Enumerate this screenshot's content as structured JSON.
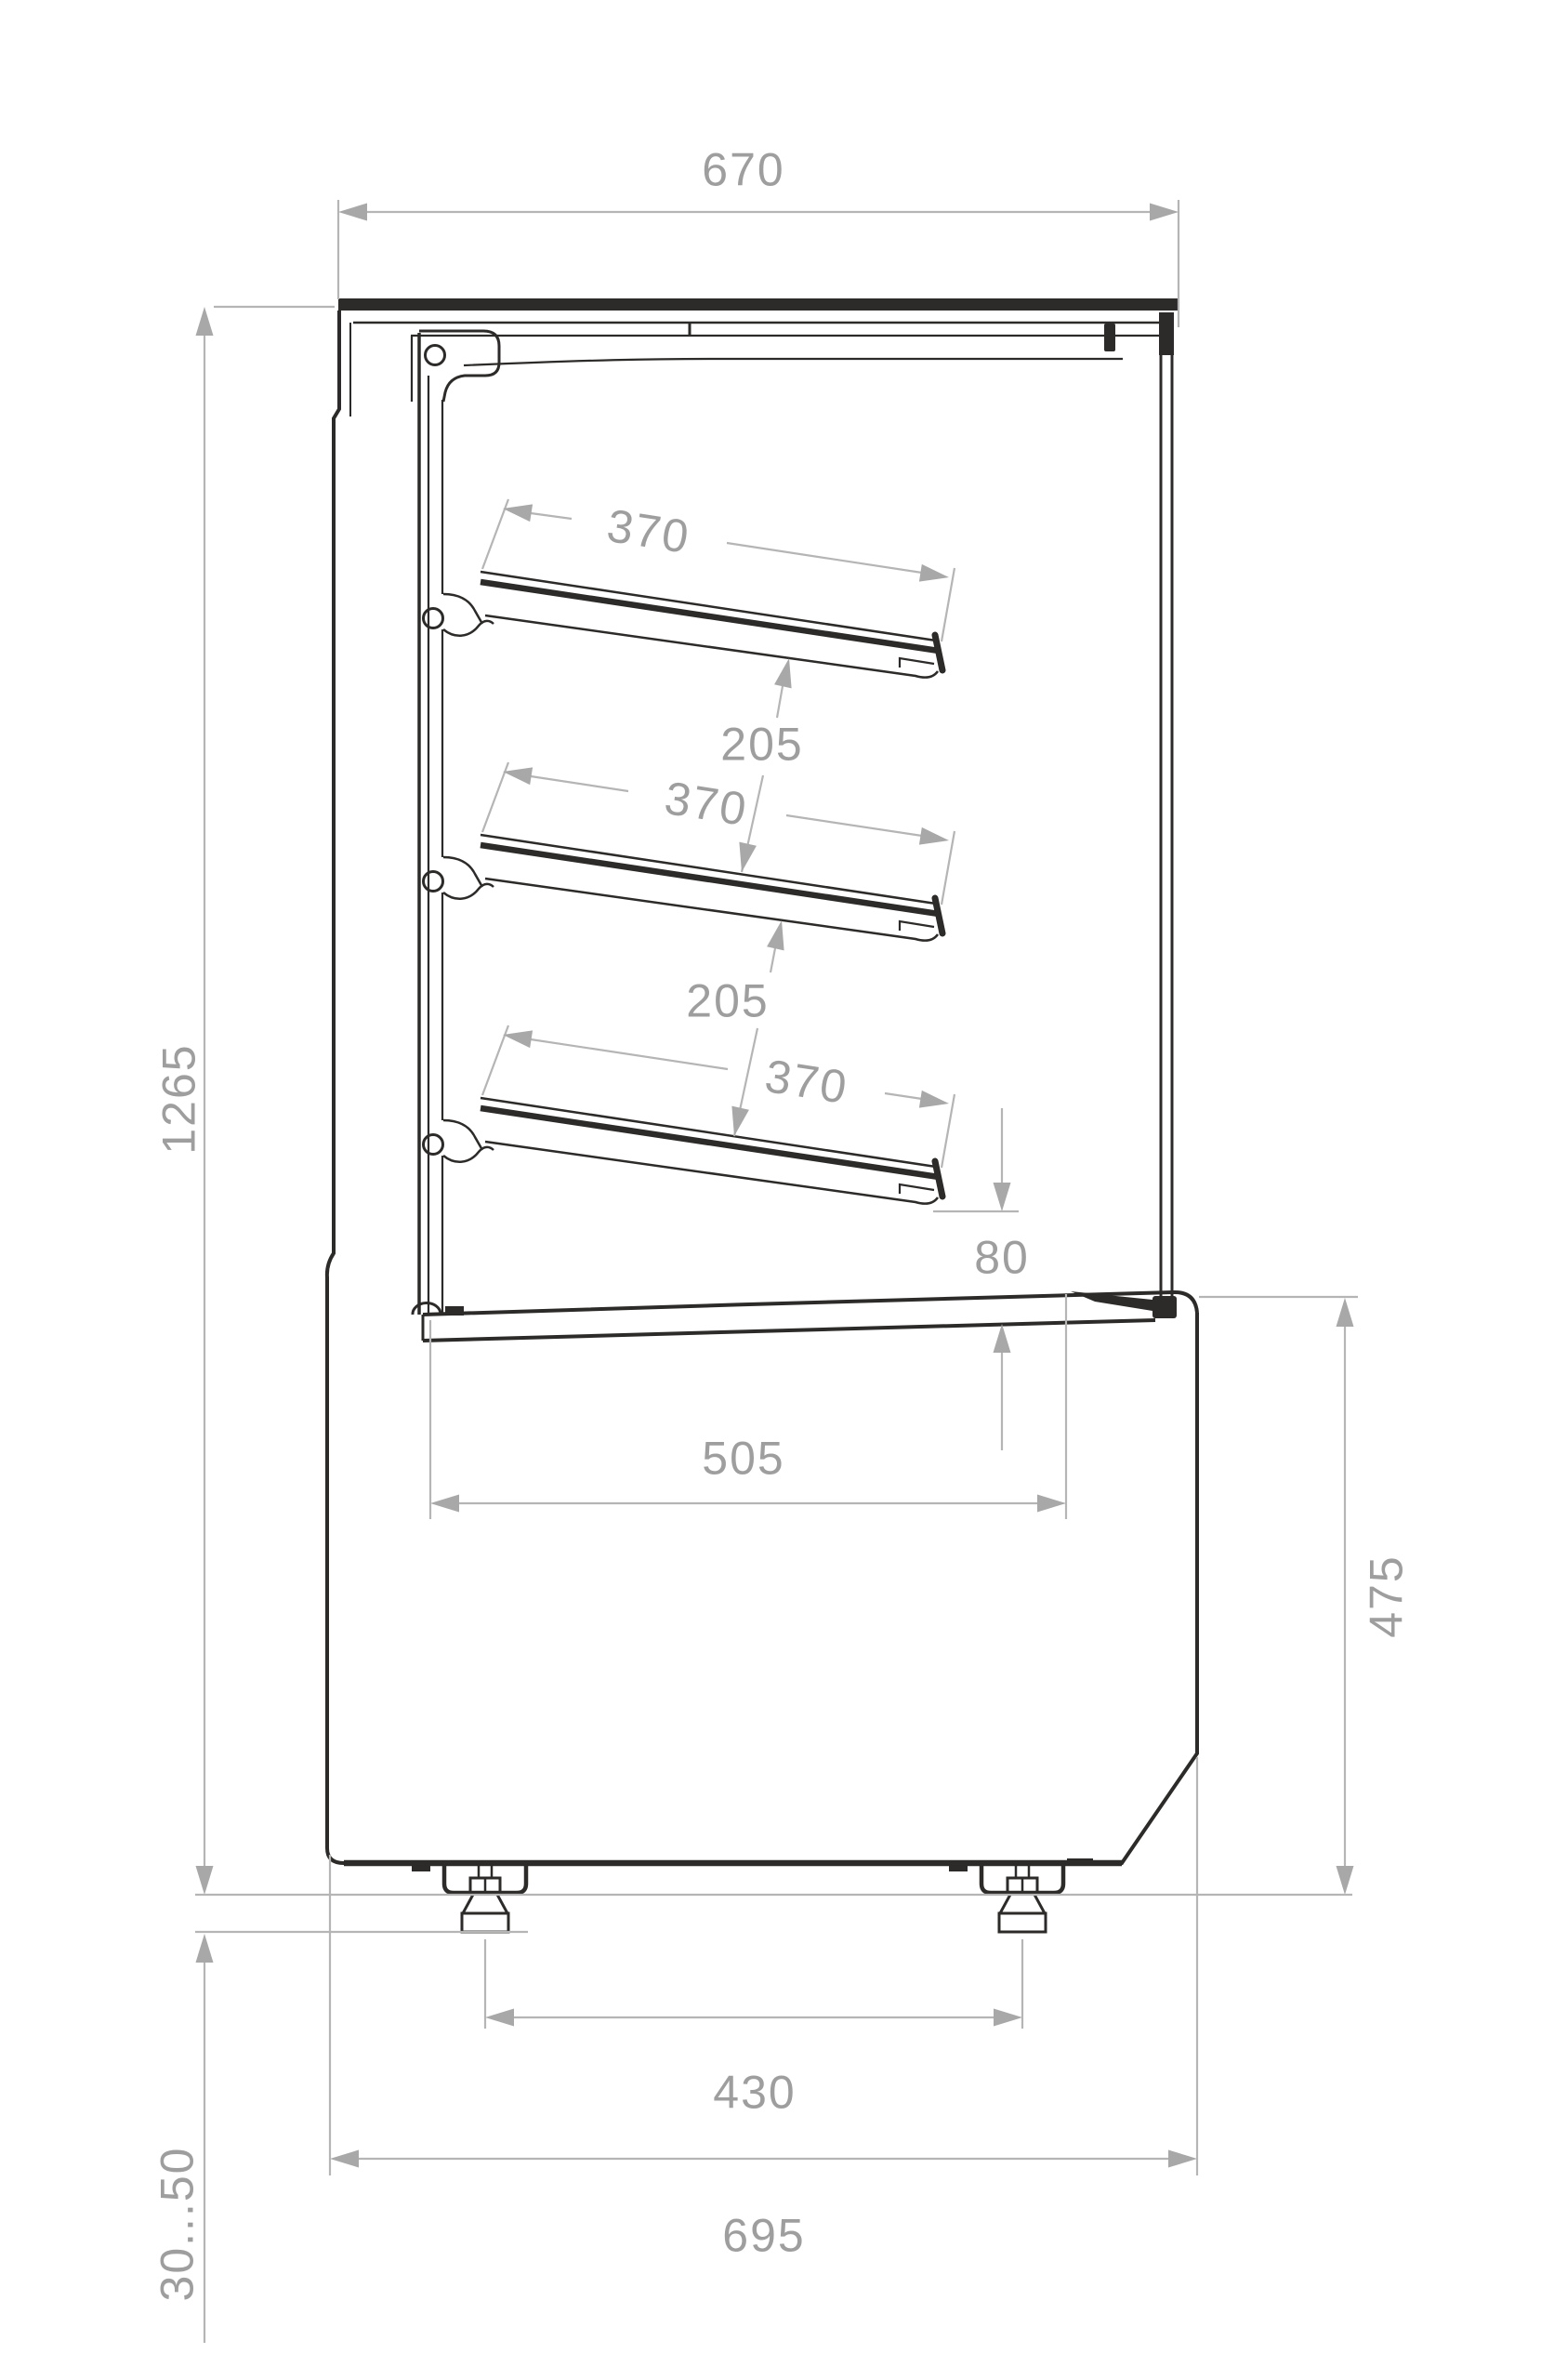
{
  "drawing": {
    "title": "Refrigerated display case – side section with dimensions",
    "units": "mm",
    "colors": {
      "outline": "#2d2b29",
      "dim_line": "#b5b5b5",
      "arrow": "#a8a8a8",
      "dim_text": "#9e9e9e",
      "background": "#ffffff"
    },
    "dims": {
      "overall_width": "670",
      "overall_height": "1265",
      "shelf_depth": "370",
      "shelf_pitch": "205",
      "deck_gap": "80",
      "deck_depth": "505",
      "base_height": "475",
      "foot_pitch": "430",
      "base_depth": "695",
      "foot_adjust_range": "30...50"
    }
  }
}
